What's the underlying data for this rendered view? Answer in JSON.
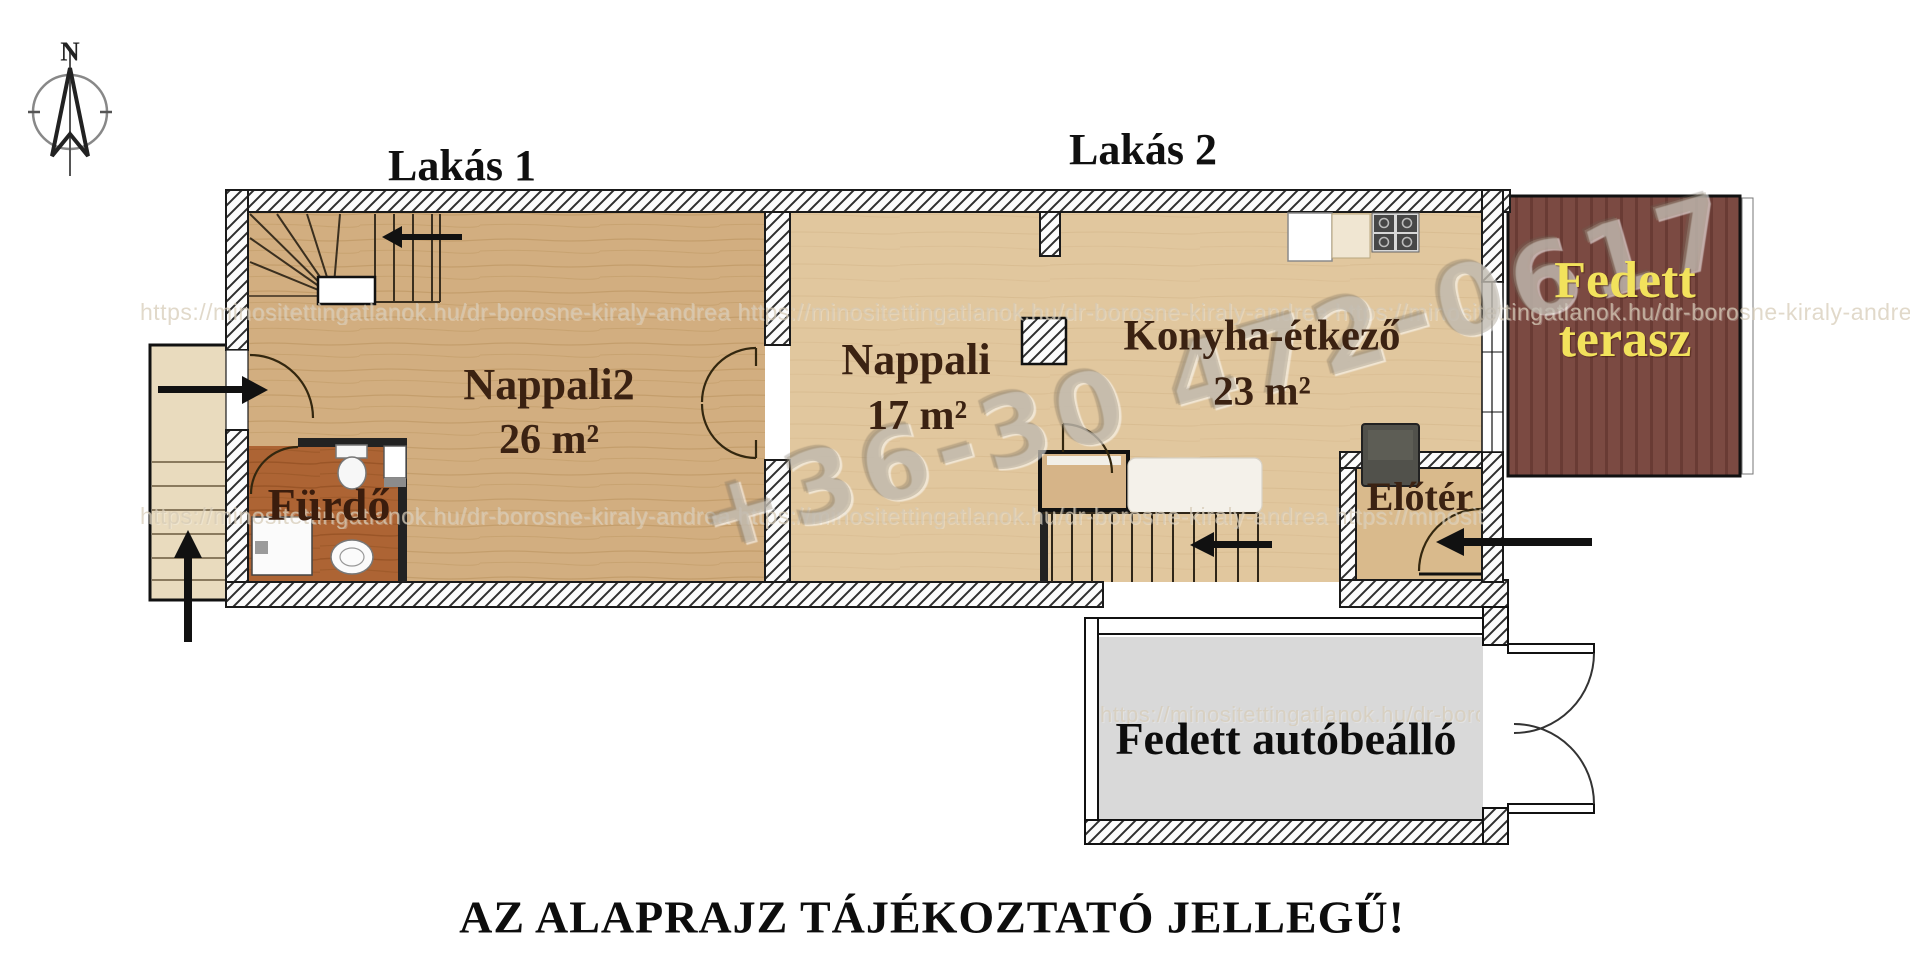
{
  "compass": {
    "north": "N"
  },
  "labels": {
    "lakas1": "Lakás 1",
    "lakas2": "Lakás 2"
  },
  "rooms": {
    "nappali2": {
      "name": "Nappali2",
      "area": "26 m²"
    },
    "furdo": {
      "name": "Fürdő"
    },
    "nappali": {
      "name": "Nappali",
      "area": "17 m²"
    },
    "konyha_etkezo": {
      "name": "Konyha-étkező",
      "area": "23 m²"
    },
    "eloter": {
      "name": "Előtér"
    },
    "fedett_terasz": {
      "line1": "Fedett",
      "line2": "terasz"
    },
    "fedett_autobeallo": {
      "name": "Fedett autóbeálló"
    }
  },
  "watermarks": {
    "phone": "+36-30 472-0617",
    "url_row1": "https://minositettingatlanok.hu/dr-borosne-kiraly-andrea   https://minositettingatlanok.hu/dr-borosne-kiraly-andrea   https://minositettingatlanok.hu/dr-borosne-kiraly-andrea",
    "url_row2": "https://minositettingatlanok.hu/dr-borosne-kiraly-andrea   https://minositettingatlanok.hu/dr-borosne-kiraly-andrea   https://minositettingatlanok.hu/dr-borosne-kiraly-andrea",
    "url_row3": "https://minositettingatlanok.hu/dr-borosne-kiraly-andrea"
  },
  "footer": {
    "disclaimer": "AZ ALAPRAJZ TÁJÉKOZTATÓ JELLEGŰ!"
  },
  "colors": {
    "apartment1_floor": "#d2ae80",
    "apartment2_floor": "#e1c79e",
    "bathroom_floor": "#ad6434",
    "terrace_floor": "#7b4a42",
    "terrace_text": "#f2e25c",
    "carport_floor": "#d9d9d9",
    "room_text": "#3b2212"
  }
}
